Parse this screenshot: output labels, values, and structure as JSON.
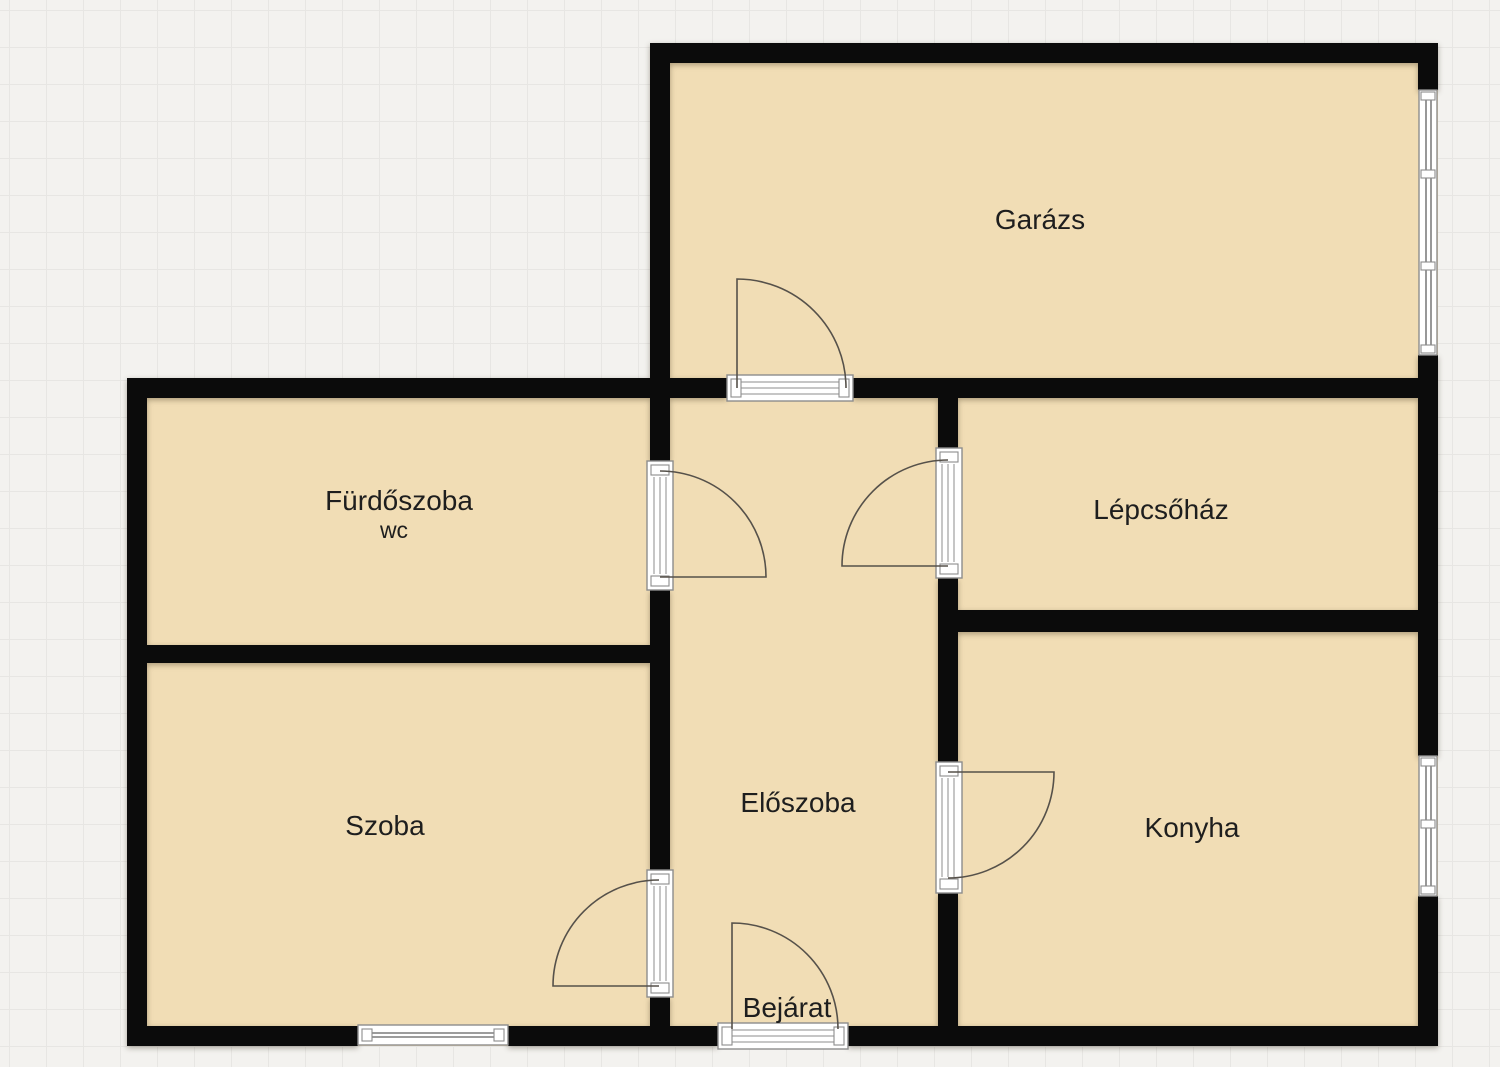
{
  "floorplan": {
    "rooms": [
      {
        "id": "garazs",
        "label": "Garázs"
      },
      {
        "id": "furdoszoba",
        "label": "Fürdőszoba",
        "sublabel": "wc"
      },
      {
        "id": "lepcsohaz",
        "label": "Lépcsőház"
      },
      {
        "id": "szoba",
        "label": "Szoba"
      },
      {
        "id": "eloszoba",
        "label": "Előszoba"
      },
      {
        "id": "konyha",
        "label": "Konyha"
      }
    ],
    "entrance_label": "Bejárat",
    "counts": {
      "doors": 6,
      "windows": 3
    },
    "colors": {
      "canvas_bg": "#f3f2ef",
      "grid_line": "#e7e6e3",
      "room_fill": "#f1ddb5",
      "wall": "#0b0b0b",
      "door_arc": "#56514a",
      "frame_fill": "#ffffff",
      "frame_line": "#8d8d8d",
      "glass_line": "#606060",
      "label_text": "#1e1e1e"
    }
  }
}
